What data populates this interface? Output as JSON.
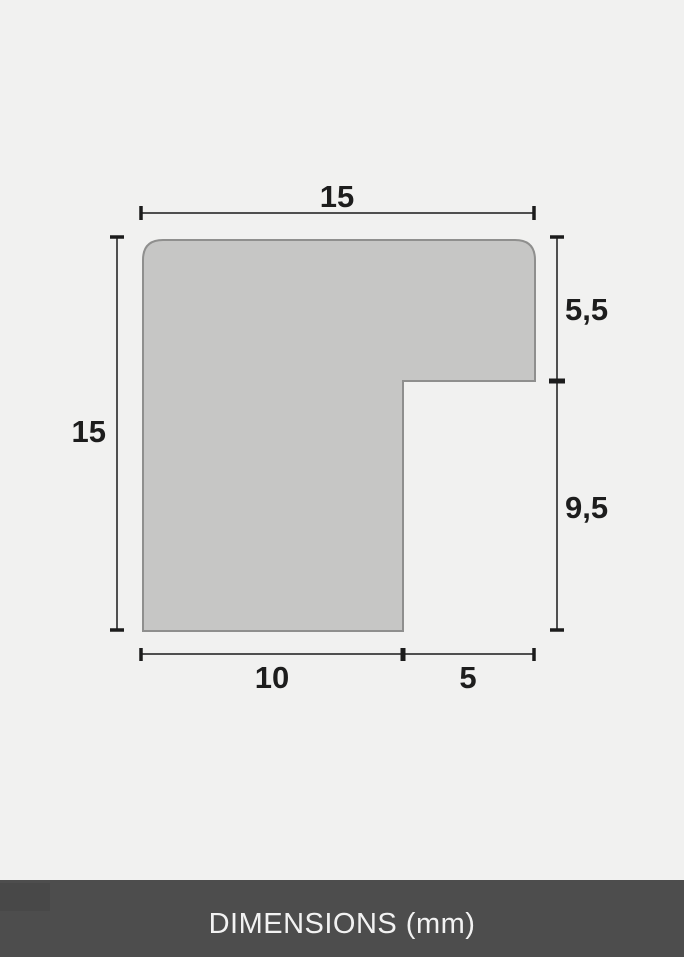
{
  "dimensions": {
    "unit_label": "mm",
    "top_width": "15",
    "left_height": "15",
    "right_upper": "5,5",
    "right_lower": "9,5",
    "bottom_left": "10",
    "bottom_right": "5"
  },
  "footer": {
    "label": "DIMENSIONS (mm)"
  },
  "colors": {
    "background": "#f1f1f0",
    "profile_fill": "#c6c6c5",
    "profile_stroke": "#8f8f8e",
    "dimension_line": "#4f4f4f",
    "tick": "#1c1c1c",
    "label_text": "#1d1d1d",
    "footer_background": "#4d4d4d",
    "footer_text": "#f2f2f2"
  }
}
